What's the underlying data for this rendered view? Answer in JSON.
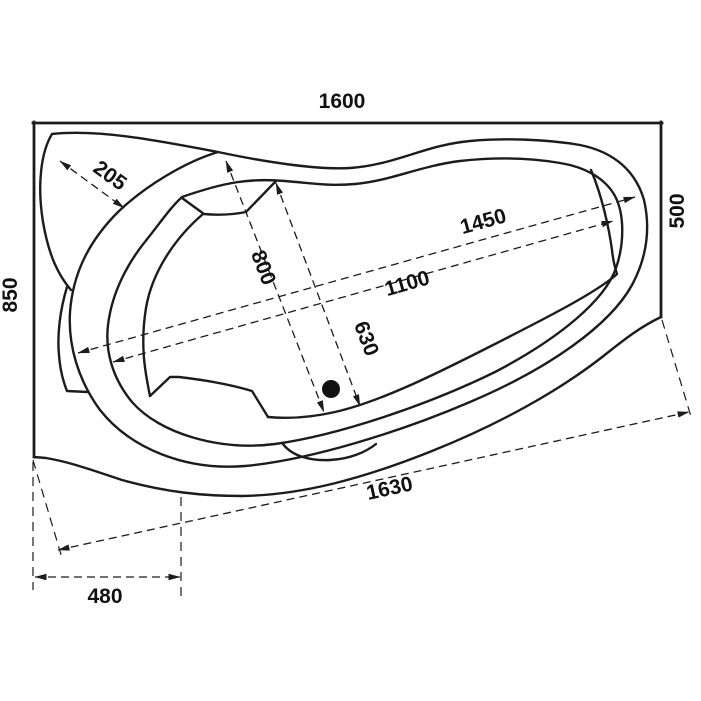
{
  "drawing": {
    "subject": "corner-bathtub-top-view-technical-drawing",
    "background_color": "#ffffff",
    "line_color": "#1c1c1c",
    "dimensions": {
      "top_width": "1600",
      "left_depth": "850",
      "right_depth": "500",
      "corner_shelf": "205",
      "basin_width": "800",
      "drain_offset": "630",
      "rim_length": "1450",
      "basin_length": "1100",
      "diagonal_length": "1630",
      "apron_offset": "480"
    }
  }
}
